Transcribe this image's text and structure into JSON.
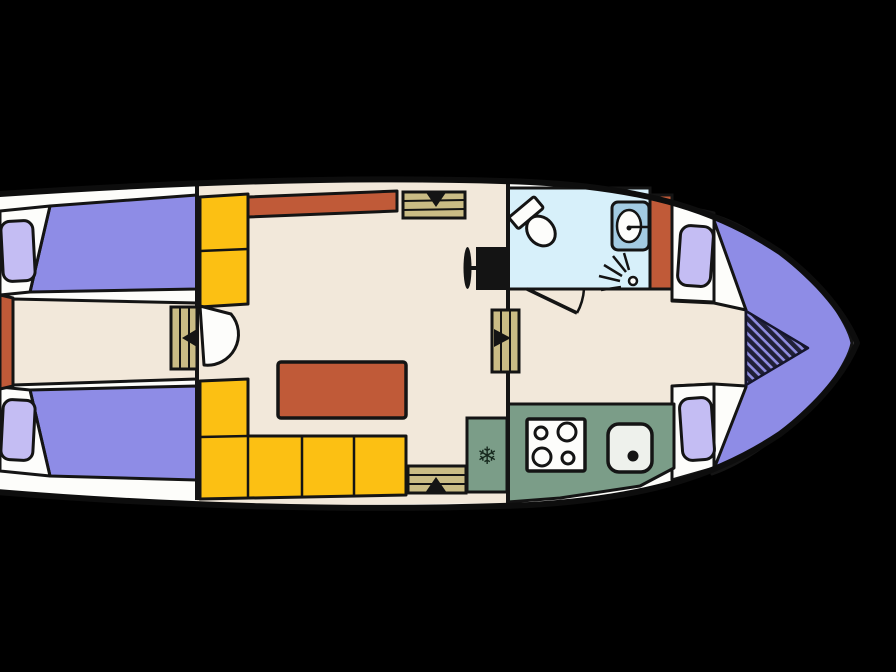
{
  "meta": {
    "type": "boat-floor-plan",
    "description": "Top-down deck layout of a motor cruiser, bow pointing right, stern clipped at left edge",
    "visible_text": "none"
  },
  "colors": {
    "background": "#000000",
    "ink": "#141414",
    "deck": "#fdfdfa",
    "floor": "#f2e8da",
    "bed": "#8e8ce6",
    "pillow": "#c4bdf3",
    "seat": "#fcc013",
    "table": "#c05a38",
    "steps": "#cabc85",
    "bath_floor": "#d7f0fa",
    "basin": "#a3cbe2",
    "fixture": "#fdfdfb",
    "galley": "#7b9d88",
    "sink": "#eef1ec",
    "hatch_dark": "#202038",
    "hatch_light": "#8f8ce0",
    "snowflake_ink": "#16281d"
  },
  "icons": {
    "snowflake": "❄"
  },
  "legend": {
    "aft_cabin": [
      "port single berth with pillow",
      "starboard single berth with pillow",
      "stern locker",
      "cabin door with swing arc",
      "side steps with arrow"
    ],
    "saloon": [
      "side bench",
      "sideboard counter",
      "entry steps down",
      "helm wheel and console",
      "dining table",
      "L-shaped sofa",
      "entry steps up",
      "fridge with snowflake"
    ],
    "bathroom": [
      "toilet",
      "washbasin with faucet",
      "shower head",
      "door with swing arc"
    ],
    "galley": [
      "four burner stove",
      "sink with drain"
    ],
    "bow_cabin": [
      "V-berth",
      "port pillow",
      "starboard pillow",
      "hatched infill cushion"
    ]
  }
}
